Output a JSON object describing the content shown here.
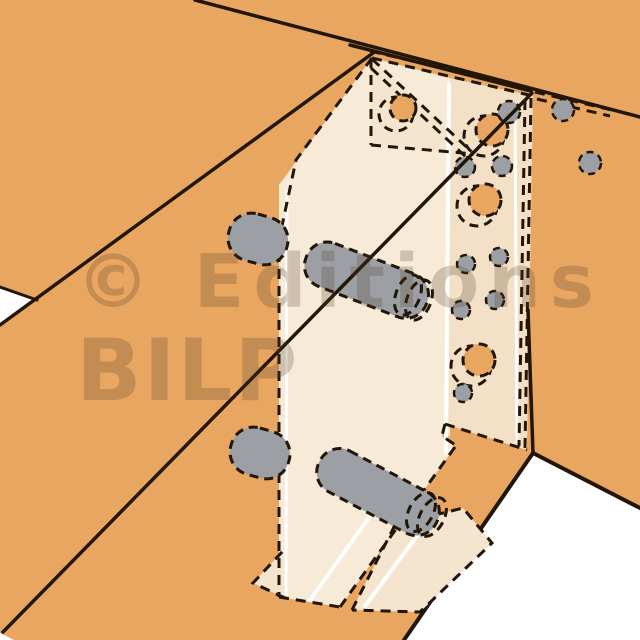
{
  "title": "Technical illustration of a concealed angle bracket timber joint with dowels",
  "watermark": {
    "line1": "© Editions",
    "line2": "BILP"
  },
  "palette": {
    "background": "#FFFFFF",
    "wood": "#E9A661",
    "line": "#221608",
    "bracket_light": "#F7EAD6",
    "bracket_mid": "#F5E5CE",
    "bracket_dark": "#F3E0C6",
    "metal_gray": "#9CA0A5",
    "highlight": "#FFFFFF",
    "watermark_color": "#503E29"
  },
  "scene": {
    "width": 640,
    "height": 640,
    "elements": [
      {
        "name": "background",
        "type": "rect",
        "x": 0,
        "y": 0,
        "w": 640,
        "h": 640,
        "fill": "$background"
      },
      {
        "name": "wood-surface",
        "type": "rect",
        "x": 0,
        "y": 0,
        "w": 640,
        "h": 640,
        "fill": "$wood"
      },
      {
        "name": "gap-white-left",
        "type": "polygon",
        "points": "0,288 37,300 0,326",
        "fill": "$background"
      },
      {
        "name": "gap-white-bottom-left",
        "type": "polygon",
        "points": "0,633 14,640 0,640",
        "fill": "$background"
      },
      {
        "name": "background-bottom-right",
        "type": "polygon",
        "points": "533,455 640,509 640,640 404,640",
        "fill": "$background"
      },
      {
        "name": "beam-top-far-edge",
        "type": "line",
        "x1": 195,
        "y1": 0,
        "x2": 640,
        "y2": 117,
        "stroke": "$line",
        "sw": 3.5
      },
      {
        "name": "beam-top-near-edge",
        "type": "line",
        "x1": 350,
        "y1": 45,
        "x2": 531,
        "y2": 91,
        "stroke": "$line",
        "sw": 3.5
      },
      {
        "name": "beam-left-upper-edge",
        "type": "line",
        "x1": 0,
        "y1": 325,
        "x2": 373,
        "y2": 53,
        "stroke": "$line",
        "sw": 3.5
      },
      {
        "name": "panel-left-edge",
        "type": "line",
        "x1": 0,
        "y1": 287,
        "x2": 37,
        "y2": 300,
        "stroke": "$line",
        "sw": 3
      },
      {
        "name": "beam-bottom-left-edge",
        "type": "line",
        "x1": 533,
        "y1": 453,
        "x2": 404,
        "y2": 640,
        "stroke": "$line",
        "sw": 4
      },
      {
        "name": "beam-bottom-right-edge",
        "type": "line",
        "x1": 533,
        "y1": 453,
        "x2": 640,
        "y2": 508,
        "stroke": "$line",
        "sw": 4
      },
      {
        "name": "bracket-web-face",
        "type": "polygon",
        "points": "372,58 450,78 450,438 444,424 442,436 455,447 340,607 279,597 279,185",
        "fill": "$bracket_light"
      },
      {
        "name": "bracket-flange-face",
        "type": "polygon",
        "points": "450,78 533,96 527,450 445,424",
        "fill": "$bracket_dark"
      },
      {
        "name": "bracket-fin-plate",
        "type": "polygon",
        "points": "371,58 371,145 474,154",
        "fill": "$bracket_mid"
      },
      {
        "name": "bracket-foot-left",
        "type": "polygon",
        "points": "253,583 283,551 285,598",
        "fill": "$bracket_mid"
      },
      {
        "name": "bracket-foot-tongue",
        "type": "polygon",
        "points": "395,525 463,508 492,543 420,612 352,610",
        "fill": "$bracket_mid"
      },
      {
        "name": "fold-highlight",
        "type": "line",
        "x1": 449,
        "y1": 84,
        "x2": 446,
        "y2": 452,
        "stroke": "$highlight",
        "sw": 4
      },
      {
        "name": "flange-highlight",
        "type": "line",
        "x1": 515,
        "y1": 104,
        "x2": 517,
        "y2": 442,
        "stroke": "$highlight",
        "sw": 3
      },
      {
        "name": "web-left-highlight",
        "type": "line",
        "x1": 287,
        "y1": 192,
        "x2": 286,
        "y2": 594,
        "stroke": "$highlight",
        "sw": 3
      },
      {
        "name": "foot-highlight-left",
        "type": "line",
        "x1": 310,
        "y1": 600,
        "x2": 370,
        "y2": 516,
        "stroke": "$highlight",
        "sw": 4
      },
      {
        "name": "foot-highlight-right",
        "type": "line",
        "x1": 365,
        "y1": 606,
        "x2": 428,
        "y2": 521,
        "stroke": "$highlight",
        "sw": 4
      },
      {
        "name": "bracket-top-edge-dash",
        "type": "line",
        "x1": 372,
        "y1": 58,
        "x2": 533,
        "y2": 96,
        "stroke": "$line",
        "sw": 3,
        "dash": "10 7"
      },
      {
        "name": "bracket-top-edge-dash-outer",
        "type": "line",
        "x1": 370,
        "y1": 51,
        "x2": 531,
        "y2": 89,
        "stroke": "$line",
        "sw": 3,
        "dash": "10 7"
      },
      {
        "name": "bracket-top-tongue-dash-upper",
        "type": "line",
        "x1": 535,
        "y1": 92,
        "x2": 612,
        "y2": 110,
        "stroke": "$line",
        "sw": 3,
        "dash": "10 7"
      },
      {
        "name": "bracket-top-tongue-dash-lower",
        "type": "line",
        "x1": 537,
        "y1": 99,
        "x2": 610,
        "y2": 116,
        "stroke": "$line",
        "sw": 3,
        "dash": "10 7"
      },
      {
        "name": "bracket-bend-dash-outer",
        "type": "line",
        "x1": 531,
        "y1": 98,
        "x2": 525,
        "y2": 448,
        "stroke": "$line",
        "sw": 3,
        "dash": "10 7"
      },
      {
        "name": "bracket-bend-dash-inner",
        "type": "line",
        "x1": 525,
        "y1": 100,
        "x2": 519,
        "y2": 446,
        "stroke": "$line",
        "sw": 3,
        "dash": "10 7"
      },
      {
        "name": "flange-bottom-edge-dash",
        "type": "line",
        "x1": 445,
        "y1": 424,
        "x2": 527,
        "y2": 450,
        "stroke": "$line",
        "sw": 3,
        "dash": "10 7"
      },
      {
        "name": "flange-notch-dash",
        "type": "polyline",
        "points": "445,424 442,436 457,446",
        "stroke": "$line",
        "sw": 3,
        "dash": "10 7"
      },
      {
        "name": "web-bottom-diagonal-dash",
        "type": "line",
        "x1": 455,
        "y1": 447,
        "x2": 340,
        "y2": 607,
        "stroke": "$line",
        "sw": 3,
        "dash": "10 7"
      },
      {
        "name": "web-left-edge-dash",
        "type": "polyline",
        "points": "372,58 296,160 279,240 279,597",
        "stroke": "$line",
        "sw": 3,
        "dash": "10 7"
      },
      {
        "name": "web-bottom-edge-dash",
        "type": "line",
        "x1": 279,
        "y1": 597,
        "x2": 340,
        "y2": 607,
        "stroke": "$line",
        "sw": 3,
        "dash": "10 7"
      },
      {
        "name": "fin-vertical-edge-dash",
        "type": "line",
        "x1": 371,
        "y1": 58,
        "x2": 371,
        "y2": 145,
        "stroke": "$line",
        "sw": 3,
        "dash": "10 7"
      },
      {
        "name": "fin-hypotenuse-dash",
        "type": "line",
        "x1": 372,
        "y1": 59,
        "x2": 474,
        "y2": 154,
        "stroke": "$line",
        "sw": 3,
        "dash": "10 7"
      },
      {
        "name": "fin-hypotenuse-dash-inner",
        "type": "line",
        "x1": 371,
        "y1": 68,
        "x2": 466,
        "y2": 157,
        "stroke": "$line",
        "sw": 3,
        "dash": "10 7"
      },
      {
        "name": "fin-bottom-edge-dash",
        "type": "line",
        "x1": 371,
        "y1": 145,
        "x2": 474,
        "y2": 154,
        "stroke": "$line",
        "sw": 3,
        "dash": "10 7"
      },
      {
        "name": "foot-left-edge-dash",
        "type": "polyline",
        "points": "285,598 253,583 283,551",
        "stroke": "$line",
        "sw": 3,
        "dash": "10 7"
      },
      {
        "name": "foot-tongue-edge-dash",
        "type": "polyline",
        "points": "352,610 395,525 463,508 492,543 420,612 352,610",
        "stroke": "$line",
        "sw": 3,
        "dash": "10 7"
      },
      {
        "name": "fin-hole-outer-ring",
        "type": "circle",
        "cx": 396,
        "cy": 114,
        "r": 17,
        "stroke": "$line",
        "sw": 3,
        "dash": "9 6"
      },
      {
        "name": "fin-hole",
        "type": "circle",
        "cx": 403,
        "cy": 108,
        "r": 13,
        "fill": "$wood",
        "stroke": "$line",
        "sw": 3,
        "dash": "9 6"
      },
      {
        "name": "flange-hole-1-outer-ring",
        "type": "circle",
        "cx": 484,
        "cy": 136,
        "r": 20,
        "stroke": "$line",
        "sw": 3,
        "dash": "9 6"
      },
      {
        "name": "flange-hole-1",
        "type": "circle",
        "cx": 492,
        "cy": 130,
        "r": 16,
        "fill": "$wood",
        "stroke": "$line",
        "sw": 3,
        "dash": "9 6"
      },
      {
        "name": "flange-hole-2-outer-ring",
        "type": "circle",
        "cx": 477,
        "cy": 206,
        "r": 20,
        "stroke": "$line",
        "sw": 3,
        "dash": "9 6"
      },
      {
        "name": "flange-hole-2",
        "type": "circle",
        "cx": 485,
        "cy": 200,
        "r": 16,
        "fill": "$wood",
        "stroke": "$line",
        "sw": 3,
        "dash": "9 6"
      },
      {
        "name": "flange-hole-3-outer-ring",
        "type": "circle",
        "cx": 471,
        "cy": 366,
        "r": 20,
        "stroke": "$line",
        "sw": 3,
        "dash": "9 6"
      },
      {
        "name": "flange-hole-3",
        "type": "circle",
        "cx": 479,
        "cy": 360,
        "r": 16,
        "fill": "$wood",
        "stroke": "$line",
        "sw": 3,
        "dash": "9 6"
      },
      {
        "name": "nail-dot-1",
        "type": "circle",
        "cx": 509,
        "cy": 112,
        "r": 11,
        "fill": "$metal_gray",
        "stroke": "$line",
        "sw": 2.5,
        "dash": "7 5"
      },
      {
        "name": "nail-dot-2",
        "type": "circle",
        "cx": 563,
        "cy": 110,
        "r": 11,
        "fill": "$metal_gray",
        "stroke": "$line",
        "sw": 2.5,
        "dash": "7 5"
      },
      {
        "name": "nail-dot-3",
        "type": "circle",
        "cx": 465,
        "cy": 167,
        "r": 10,
        "fill": "$metal_gray",
        "stroke": "$line",
        "sw": 2.5,
        "dash": "7 5"
      },
      {
        "name": "nail-dot-4",
        "type": "circle",
        "cx": 502,
        "cy": 166,
        "r": 10,
        "fill": "$metal_gray",
        "stroke": "$line",
        "sw": 2.5,
        "dash": "7 5"
      },
      {
        "name": "nail-dot-5",
        "type": "circle",
        "cx": 590,
        "cy": 163,
        "r": 11,
        "fill": "$metal_gray",
        "stroke": "$line",
        "sw": 2.5,
        "dash": "7 5"
      },
      {
        "name": "nail-dot-6",
        "type": "circle",
        "cx": 466,
        "cy": 264,
        "r": 9,
        "fill": "$metal_gray",
        "stroke": "$line",
        "sw": 2.5,
        "dash": "7 5"
      },
      {
        "name": "nail-dot-7",
        "type": "circle",
        "cx": 499,
        "cy": 257,
        "r": 9,
        "fill": "$metal_gray",
        "stroke": "$line",
        "sw": 2.5,
        "dash": "7 5"
      },
      {
        "name": "nail-dot-8",
        "type": "circle",
        "cx": 461,
        "cy": 310,
        "r": 9,
        "fill": "$metal_gray",
        "stroke": "$line",
        "sw": 2.5,
        "dash": "7 5"
      },
      {
        "name": "nail-dot-9",
        "type": "circle",
        "cx": 495,
        "cy": 300,
        "r": 9,
        "fill": "$metal_gray",
        "stroke": "$line",
        "sw": 2.5,
        "dash": "7 5"
      },
      {
        "name": "nail-dot-10",
        "type": "circle",
        "cx": 463,
        "cy": 393,
        "r": 9,
        "fill": "$metal_gray",
        "stroke": "$line",
        "sw": 2.5,
        "dash": "7 5"
      },
      {
        "name": "dowel-plug-upper-left",
        "type": "rect",
        "x": 228,
        "y": 215,
        "w": 60,
        "h": 48,
        "rx": 23,
        "fill": "$metal_gray",
        "stroke": "$line",
        "sw": 3,
        "dash": "9 6",
        "rotate": [
          16,
          258,
          239
        ]
      },
      {
        "name": "dowel-upper",
        "type": "rect",
        "x": 302,
        "y": 257,
        "w": 129,
        "h": 46,
        "rx": 22,
        "fill": "$metal_gray",
        "stroke": "$line",
        "sw": 3,
        "dash": "9 6",
        "rotate": [
          21,
          366,
          280
        ]
      },
      {
        "name": "dowel-upper-cap",
        "type": "ellipse",
        "cx": 408,
        "cy": 295,
        "rx": 12,
        "ry": 21,
        "stroke": "$line",
        "sw": 3,
        "dash": "9 6",
        "rotate": [
          21,
          408,
          295
        ]
      },
      {
        "name": "dowel-upper-cap-rim",
        "type": "ellipse",
        "cx": 419,
        "cy": 300,
        "rx": 12,
        "ry": 21,
        "stroke": "$line",
        "sw": 3,
        "dash": "9 6",
        "rotate": [
          21,
          419,
          300
        ]
      },
      {
        "name": "dowel-plug-lower-left",
        "type": "rect",
        "x": 230,
        "y": 429,
        "w": 60,
        "h": 48,
        "rx": 23,
        "fill": "$metal_gray",
        "stroke": "$line",
        "sw": 3,
        "dash": "9 6",
        "rotate": [
          16,
          260,
          453
        ]
      },
      {
        "name": "dowel-lower",
        "type": "rect",
        "x": 312,
        "y": 469,
        "w": 132,
        "h": 46,
        "rx": 22,
        "fill": "$metal_gray",
        "stroke": "$line",
        "sw": 3,
        "dash": "9 6",
        "rotate": [
          28,
          378,
          492
        ]
      },
      {
        "name": "dowel-lower-cap",
        "type": "ellipse",
        "cx": 421,
        "cy": 512,
        "rx": 12,
        "ry": 21,
        "stroke": "$line",
        "sw": 3,
        "dash": "9 6",
        "rotate": [
          28,
          421,
          512
        ]
      },
      {
        "name": "dowel-lower-cap-rim",
        "type": "ellipse",
        "cx": 432,
        "cy": 517,
        "rx": 12,
        "ry": 21,
        "stroke": "$line",
        "sw": 3,
        "dash": "9 6",
        "rotate": [
          28,
          432,
          517
        ]
      },
      {
        "name": "beam-front-diagonal-edge",
        "type": "line",
        "x1": 532,
        "y1": 93,
        "x2": 3,
        "y2": 632,
        "stroke": "$line",
        "sw": 3.5
      },
      {
        "name": "post-corner-edge",
        "type": "line",
        "x1": 528,
        "y1": 310,
        "x2": 533,
        "y2": 453,
        "stroke": "$line",
        "sw": 3.5
      },
      {
        "name": "watermark-line-1",
        "type": "text",
        "x": 76,
        "y": 307,
        "fs": 74,
        "fw": "bold",
        "ls": 9,
        "fill": "$watermark_color",
        "opacity": 0.24,
        "bind": "watermark.line1"
      },
      {
        "name": "watermark-line-2",
        "type": "text",
        "x": 76,
        "y": 400,
        "fs": 86,
        "fw": "bold",
        "ls": 2,
        "fill": "$watermark_color",
        "opacity": 0.24,
        "bind": "watermark.line2"
      }
    ]
  }
}
